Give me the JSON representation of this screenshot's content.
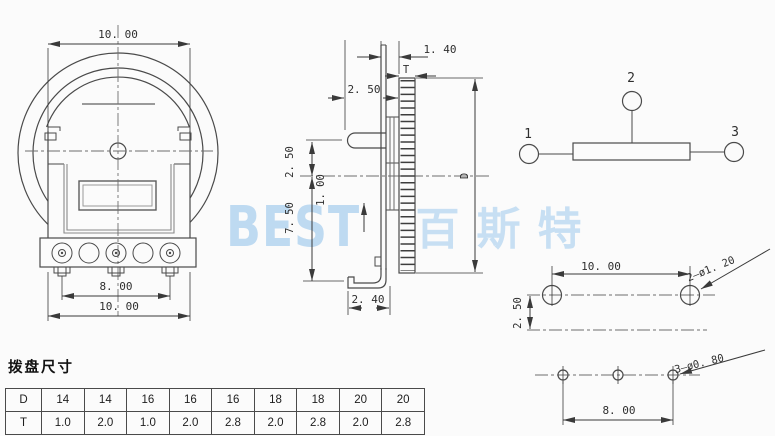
{
  "front_view": {
    "dim_top_width": "10. 00",
    "dim_pin_spacing": "8. 00",
    "dim_bottom_width": "10. 00"
  },
  "side_view": {
    "dim_wheel_protrusion": "1. 40",
    "label_wheel_thickness": "T",
    "dim_lever_horizontal": "2. 50",
    "dim_lever_to_center": "2. 50",
    "dim_center_offset": "1. 00",
    "dim_body_below_center": "7. 50",
    "dim_foot_length": "2. 40",
    "label_wheel_diameter": "D"
  },
  "schematic": {
    "terminal_1": "1",
    "terminal_2": "2",
    "terminal_3": "3"
  },
  "pcb_layout": {
    "dim_mount_hole_spacing": "10. 00",
    "dim_row_offset": "2. 50",
    "label_mount_holes": "2–ø1. 20",
    "dim_terminal_hole_spacing": "8. 00",
    "label_terminal_holes": "3–ø0. 80"
  },
  "dial_table": {
    "title": "拨盘尺寸",
    "row_d_header": "D",
    "row_t_header": "T",
    "d_values": [
      "14",
      "14",
      "16",
      "16",
      "16",
      "18",
      "18",
      "20",
      "20"
    ],
    "t_values": [
      "1.0",
      "2.0",
      "1.0",
      "2.0",
      "2.8",
      "2.0",
      "2.8",
      "2.0",
      "2.8"
    ]
  },
  "watermark": {
    "latin": "BEST",
    "cjk": "百斯特"
  },
  "colors": {
    "line": "#4a4a4a",
    "dimension": "#3a3a3a",
    "watermark": "#9cc6e8"
  }
}
